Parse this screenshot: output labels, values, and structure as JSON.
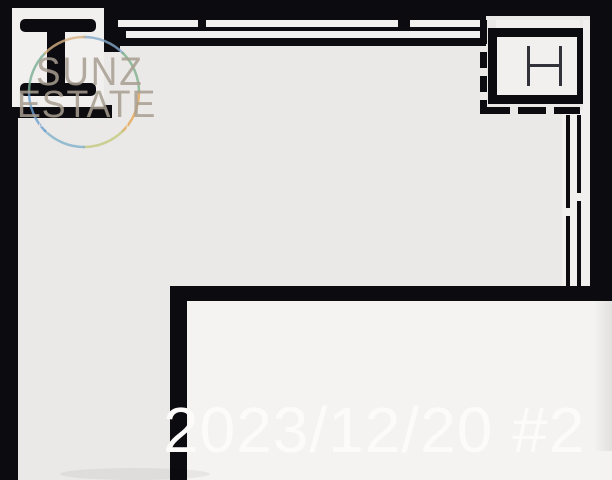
{
  "watermark": {
    "brand_line1": "SUNZ",
    "brand_line2": "ESTATE",
    "brand_sub": "サンズエステート"
  },
  "caption": {
    "date_label": "2023/12/20 #2"
  },
  "plan": {
    "symbols": {
      "left_column": "i-beam-steel-column",
      "right_column": "h-steel-column"
    }
  },
  "colors": {
    "wall": "#0b0b10",
    "floor_outer": "#ebe9e8",
    "floor_inner": "#f4f3f1",
    "box_fill": "#f1f0ee",
    "date_text": "#fcfbf9",
    "watermark_text": "#a89e90",
    "ring_blue": "#84a8c8",
    "ring_green": "#7db08a",
    "ring_orange": "#e2a653",
    "ring_yellow": "#c3c87a"
  }
}
